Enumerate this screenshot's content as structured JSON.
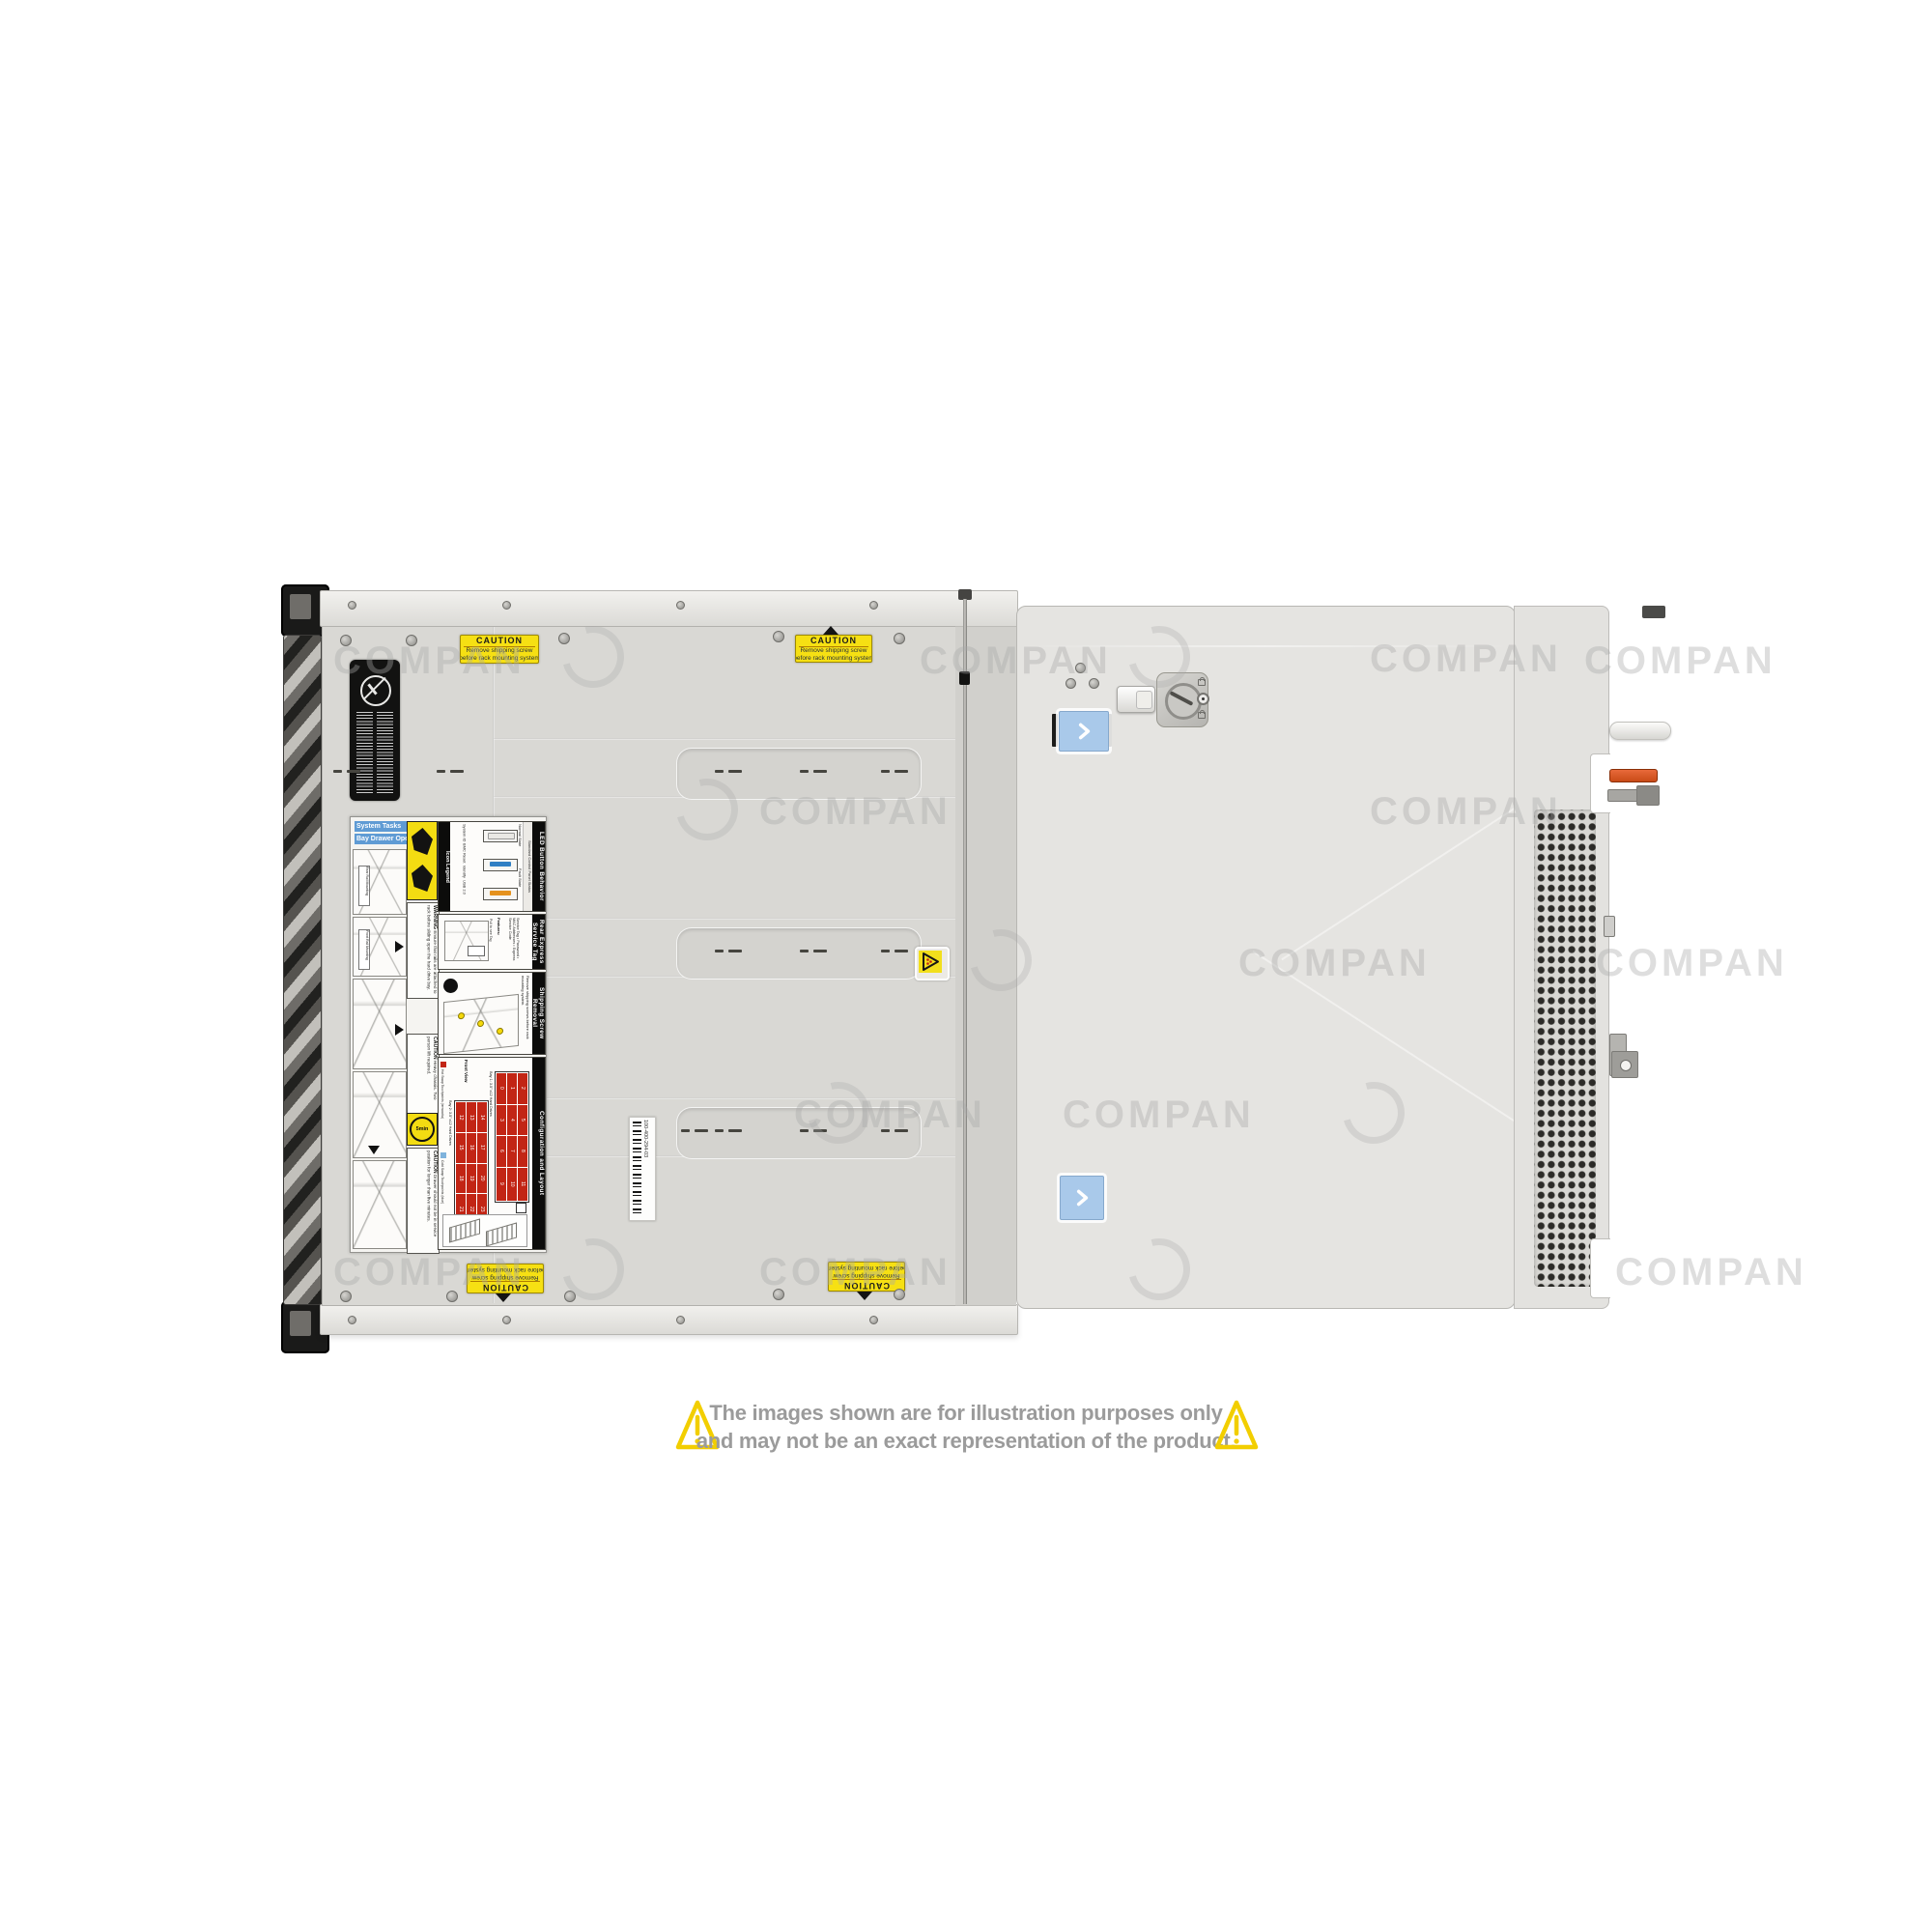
{
  "disclaimer": {
    "line1": "The images shown are for illustration purposes only",
    "line2": "and may not be an exact representation of the product."
  },
  "watermark": {
    "text": "COMPAN",
    "text_positions": [
      [
        345,
        662
      ],
      [
        952,
        662
      ],
      [
        1418,
        660
      ],
      [
        1640,
        662
      ],
      [
        786,
        818
      ],
      [
        1418,
        818
      ],
      [
        1282,
        975
      ],
      [
        1652,
        975
      ],
      [
        822,
        1132
      ],
      [
        1100,
        1132
      ],
      [
        345,
        1295
      ],
      [
        786,
        1295
      ],
      [
        1672,
        1295
      ]
    ],
    "logo_positions": [
      [
        582,
        648
      ],
      [
        1168,
        648
      ],
      [
        700,
        806
      ],
      [
        1004,
        962
      ],
      [
        836,
        1120
      ],
      [
        1390,
        1120
      ],
      [
        582,
        1282
      ],
      [
        1168,
        1282
      ]
    ]
  },
  "caution_sticker": {
    "title": "CAUTION",
    "line1": "Remove shipping screw",
    "line2": "before rack mounting system"
  },
  "barcode": {
    "part_number": "100-400-294-03"
  },
  "panel": {
    "system_tasks": "System Tasks",
    "bay_drawer_operation": "Bay Drawer Operation",
    "rail_tag_rear": "Rear Rail Mounting",
    "rail_tag_front": "Front Rail Mounting",
    "icon_legend": {
      "title": "Icon Legend",
      "items": [
        "System ID",
        "BMC Reset",
        "Identify",
        "USB 2.0"
      ]
    },
    "led": {
      "title": "LED Button Behavior",
      "subtitle": "Standard Control Panel Status",
      "normal": "Normal State",
      "fault": "Fault State"
    },
    "service_tag": {
      "title": "Rear Express Service Tag",
      "features_label": "Features:",
      "features": "Service Tag • Password • MAC Addresses • Express Service Code",
      "note": "Pull to see Tag"
    },
    "shipping": {
      "title": "Shipping Screw Removal",
      "note": "Remove shipping screws before rack mounting system."
    },
    "warning": {
      "title": "WARNING",
      "text": "Ensure that rails are attached to rack before sliding open the hard drive bay."
    },
    "caution_heavy": {
      "title": "CAUTION",
      "text": "Heavy chassis. Two person lift required."
    },
    "caution_drawer": {
      "title": "CAUTION",
      "text": "Drawer should not be in service position for longer than five minutes."
    },
    "timer": "5min",
    "config": {
      "title": "Configuration and Layout",
      "front_view": "Front View",
      "hot_swap": "Hot Swap Touchpoints (terracotta)",
      "cold_swap": "Cold Swap Touchpoints (blue)",
      "bay1_label": "Bay 1: 3.5\" x12 Hard Drives",
      "bay2_label": "Bay 2: 3.5\" x12 Hard Drives",
      "bay1_numbers": [
        0,
        1,
        2,
        3,
        4,
        5,
        6,
        7,
        8,
        9,
        10,
        11
      ],
      "bay2_numbers": [
        12,
        13,
        14,
        15,
        16,
        17,
        18,
        19,
        20,
        21,
        22,
        23
      ],
      "side_labels": "System ID / Status Light Bar • Hard Drive Activity • iDRAC Direct (Micro-AB USB) • USB • Power"
    }
  },
  "colors": {
    "accent_blue": "#a9c9ea",
    "caution_yellow": "#f6e013",
    "hot_swap_red": "#c22515",
    "lever_orange": "#d95a24",
    "triangle_yellow": "#f2ce00"
  }
}
